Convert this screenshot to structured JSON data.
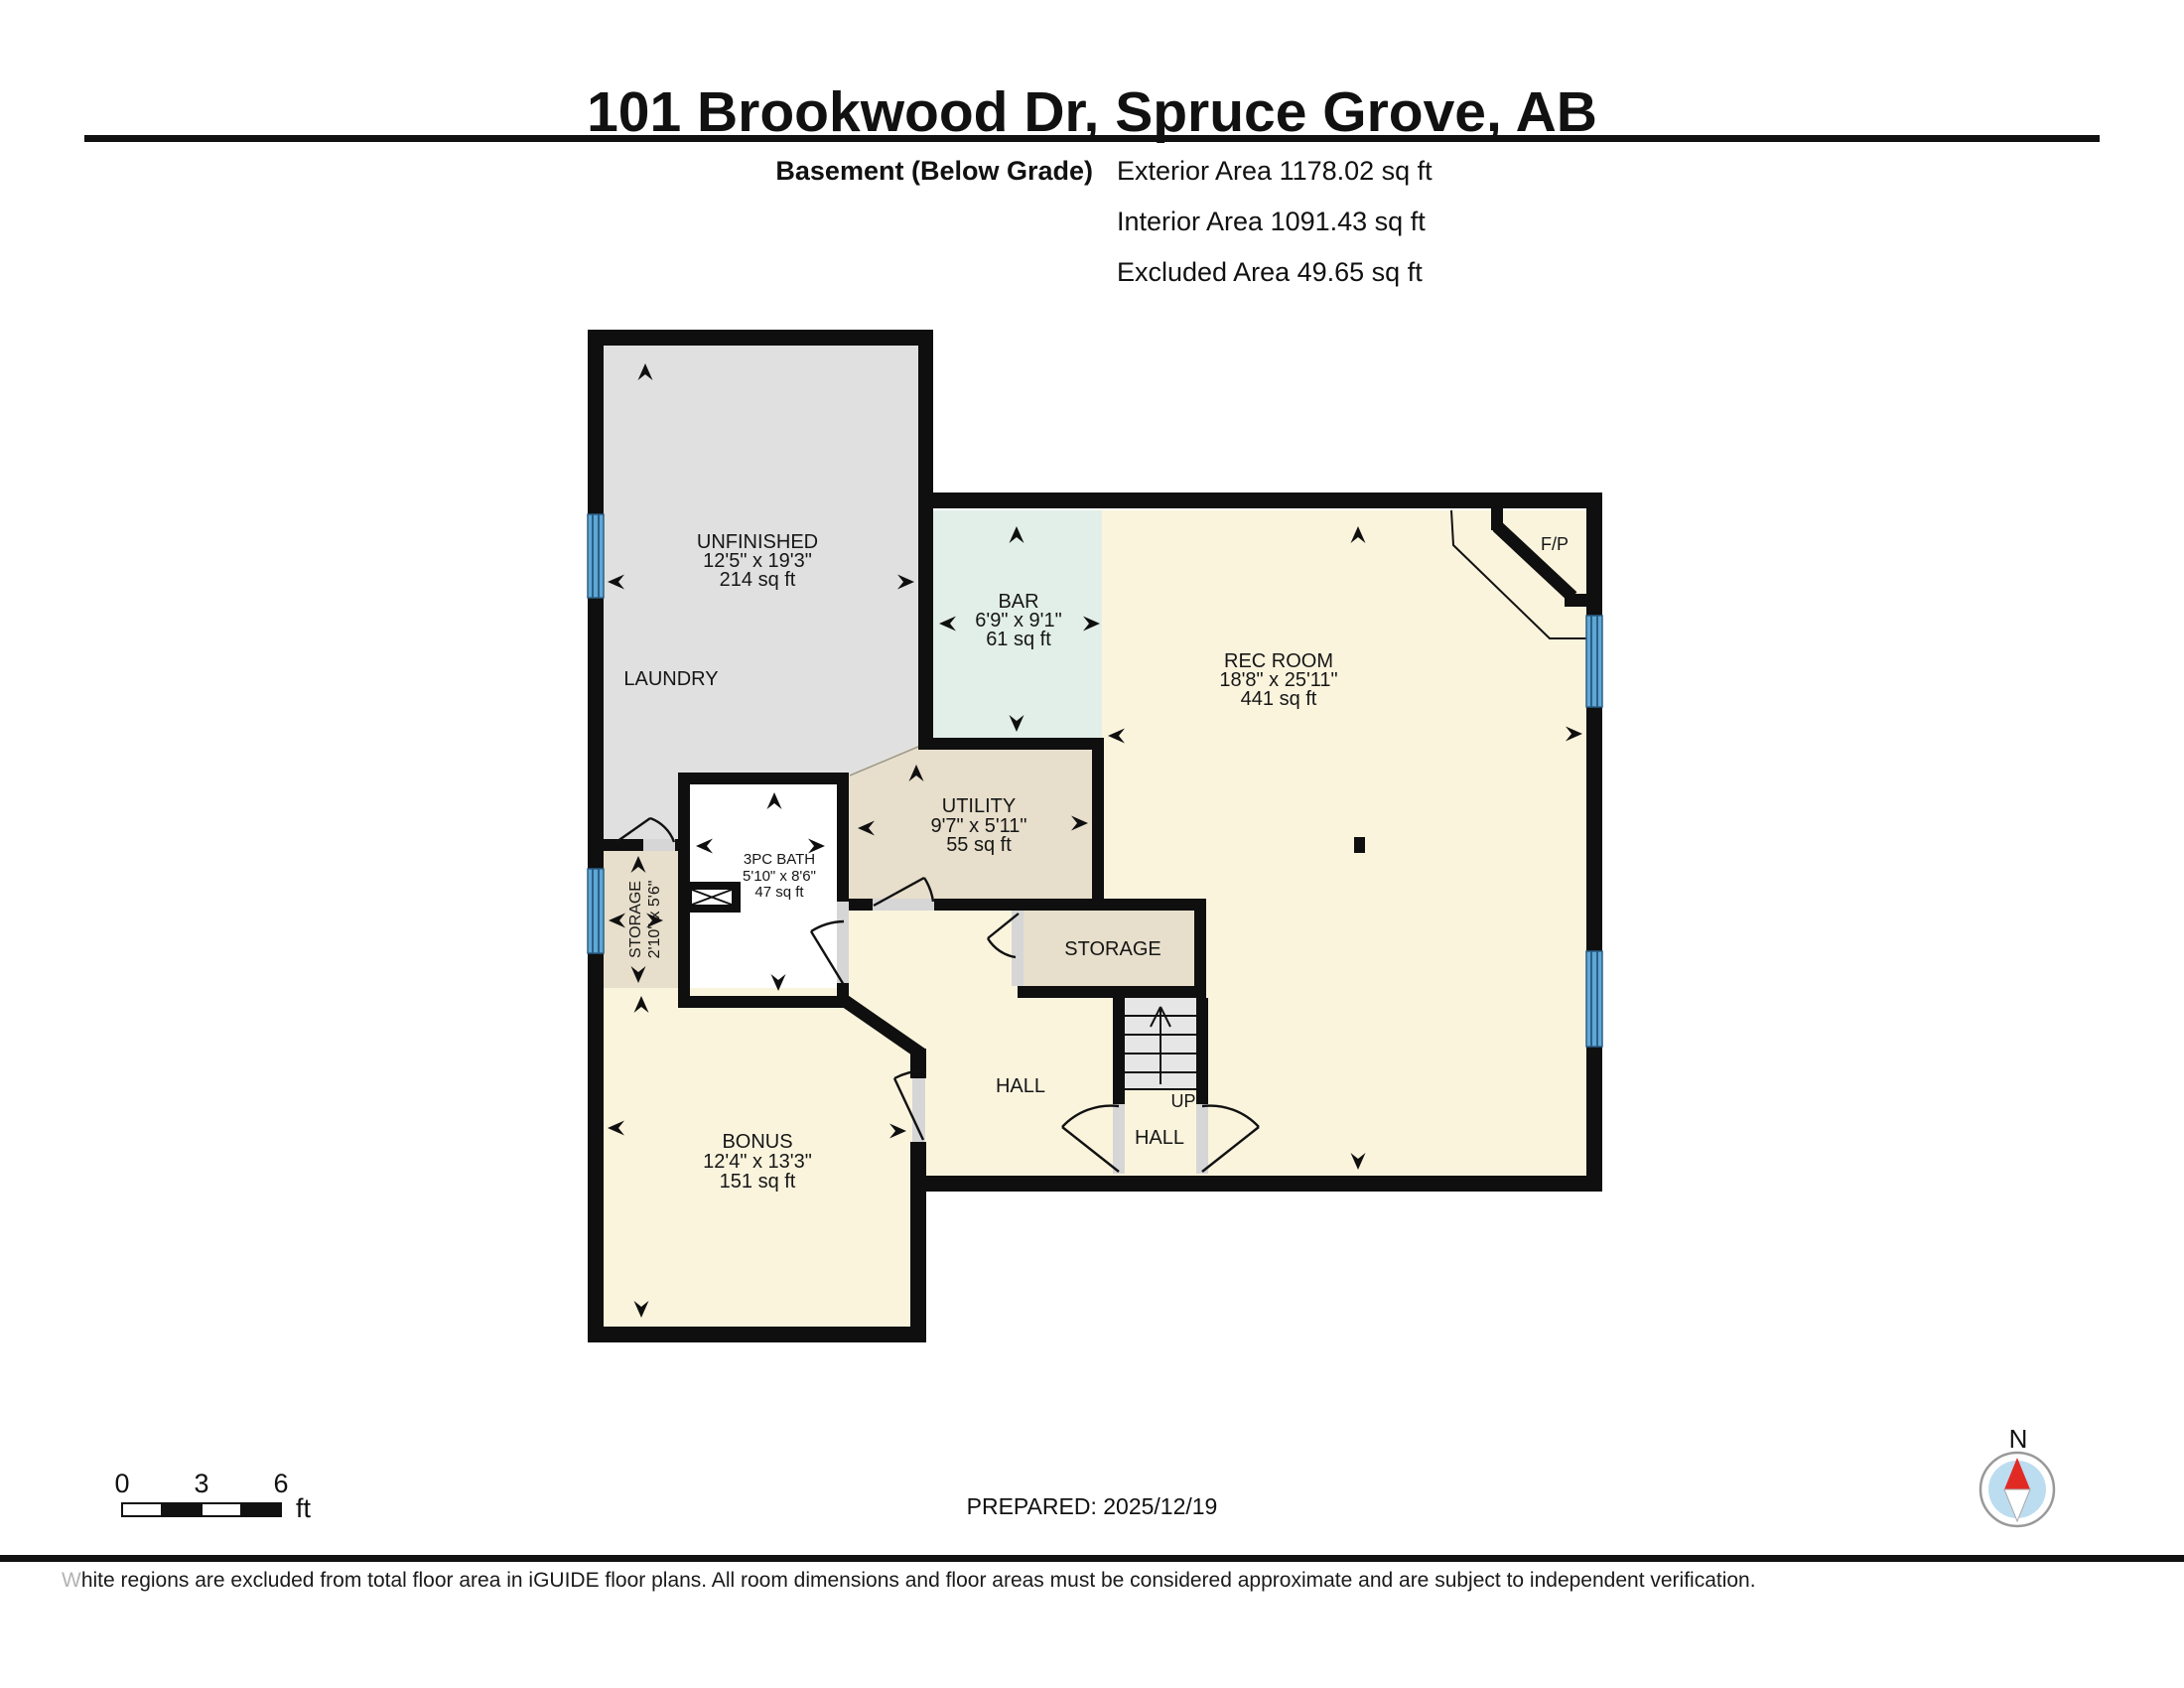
{
  "title": "101 Brookwood Dr, Spruce Grove, AB",
  "floor_info": {
    "floor_label": "Basement (Below Grade)",
    "exterior_area": "Exterior Area 1178.02 sq ft",
    "interior_area": "Interior Area 1091.43 sq ft",
    "excluded_area": "Excluded Area 49.65 sq ft"
  },
  "rooms": {
    "unfinished": {
      "name": "UNFINISHED",
      "dims": "12'5\" x 19'3\"",
      "area": "214 sq ft"
    },
    "laundry": {
      "name": "LAUNDRY"
    },
    "bar": {
      "name": "BAR",
      "dims": "6'9\" x 9'1\"",
      "area": "61 sq ft"
    },
    "rec_room": {
      "name": "REC ROOM",
      "dims": "18'8\" x 25'11\"",
      "area": "441 sq ft"
    },
    "fireplace": {
      "name": "F/P"
    },
    "utility": {
      "name": "UTILITY",
      "dims": "9'7\" x 5'11\"",
      "area": "55 sq ft"
    },
    "bath": {
      "name": "3PC BATH",
      "dims": "5'10\" x 8'6\"",
      "area": "47 sq ft"
    },
    "storage_left": {
      "name": "STORAGE",
      "dims": "2'10\" x 5'6\""
    },
    "storage_right": {
      "name": "STORAGE"
    },
    "hall_upper": {
      "name": "HALL"
    },
    "hall_lower": {
      "name": "HALL"
    },
    "bonus": {
      "name": "BONUS",
      "dims": "12'4\" x 13'3\"",
      "area": "151 sq ft"
    }
  },
  "stairs": {
    "label": "UP"
  },
  "scale_bar": {
    "tick_0": "0",
    "tick_3": "3",
    "tick_6": "6",
    "unit": "ft"
  },
  "prepared_label": "PREPARED: 2025/12/19",
  "compass": {
    "north_label": "N"
  },
  "footer_note": "White regions are excluded from total floor area in iGUIDE floor plans. All room dimensions and floor areas must be considered approximate and are subject to independent verification.",
  "colors": {
    "wall": "#0f0f0f",
    "room_cream": "#fbf4dd",
    "room_gray": "#e0e0e0",
    "room_mint": "#e2efe8",
    "room_tan": "#e7decb",
    "stairs_gray": "#e6e6e6",
    "window_blue": "#5fa8d6",
    "door_jamb": "#d6d6d6",
    "compass_red": "#e22a25",
    "compass_blue": "#bcdcf0"
  }
}
